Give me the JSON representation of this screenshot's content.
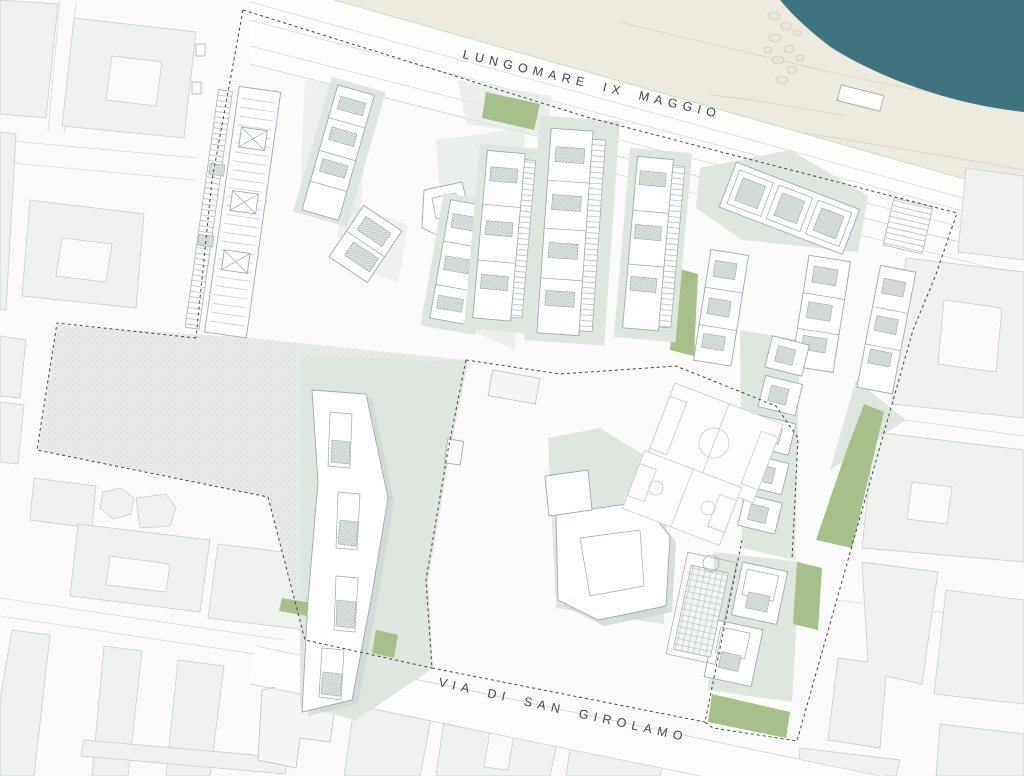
{
  "title": "Coastal masterplan site plan",
  "streets": {
    "top": "LUNGOMARE IX MAGGIO",
    "bottom": "VIA DI SAN GIROLAMO"
  },
  "colors": {
    "sea": "#3e737f",
    "beach": "#edeadf",
    "beach_contour": "#d7d5c5",
    "context_fill": "#eff1ef",
    "context_stroke": "#c6cfc9",
    "road_line": "#ccd3cd",
    "site_shade": "#dfe5df",
    "site_shade_dark": "#ccd6d0",
    "plaza_fill": "#e7eae6",
    "lawn": "#a6c08c",
    "building_fill": "#ffffff",
    "building_stroke": "#9cada7",
    "roof_fill": "#d3dad6",
    "court_line": "#c9d4ce",
    "boundary": "#454545",
    "label": "#41464a"
  }
}
